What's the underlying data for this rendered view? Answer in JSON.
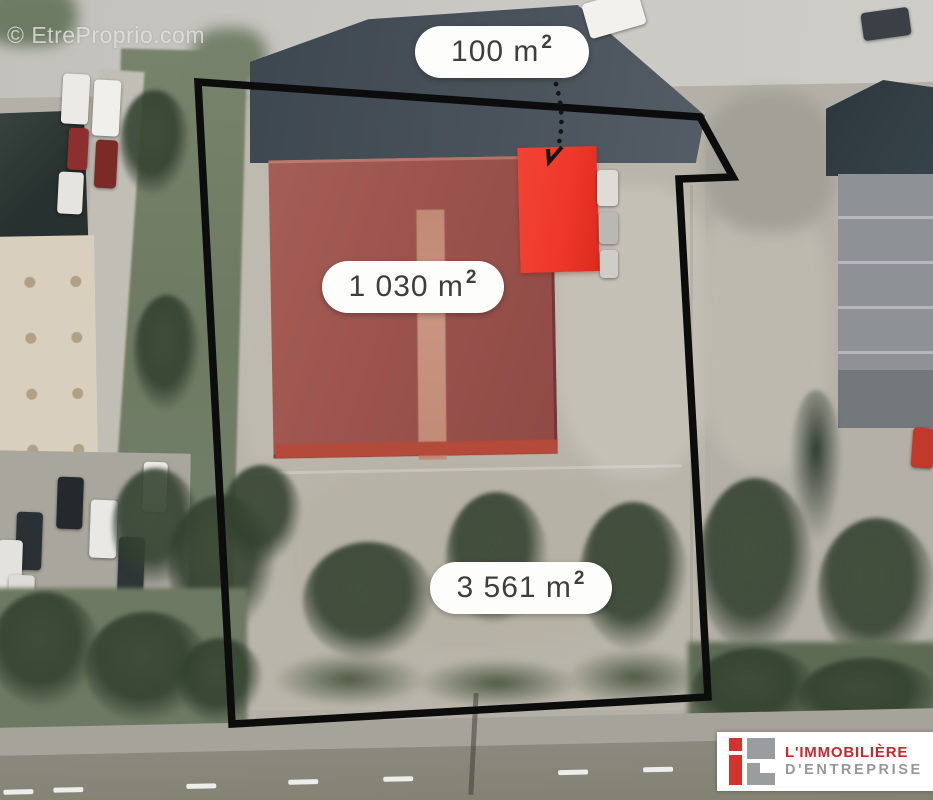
{
  "watermark": {
    "text": "© EtreProprio.com"
  },
  "areas": {
    "small": {
      "text": "100 m",
      "sup": "2"
    },
    "main": {
      "text": "1 030 m",
      "sup": "2"
    },
    "land": {
      "text": "3 561 m",
      "sup": "2"
    }
  },
  "logo": {
    "line1": "L'IMMOBILIÈRE",
    "line2": "D'ENTREPRISE"
  },
  "colors": {
    "highlight_red": "#ee392b",
    "roof_red": "#9e5851",
    "boundary_black": "#0c0c0c",
    "logo_red": "#c8272c",
    "logo_gray": "#95989b",
    "label_text": "#3e3e3e"
  }
}
